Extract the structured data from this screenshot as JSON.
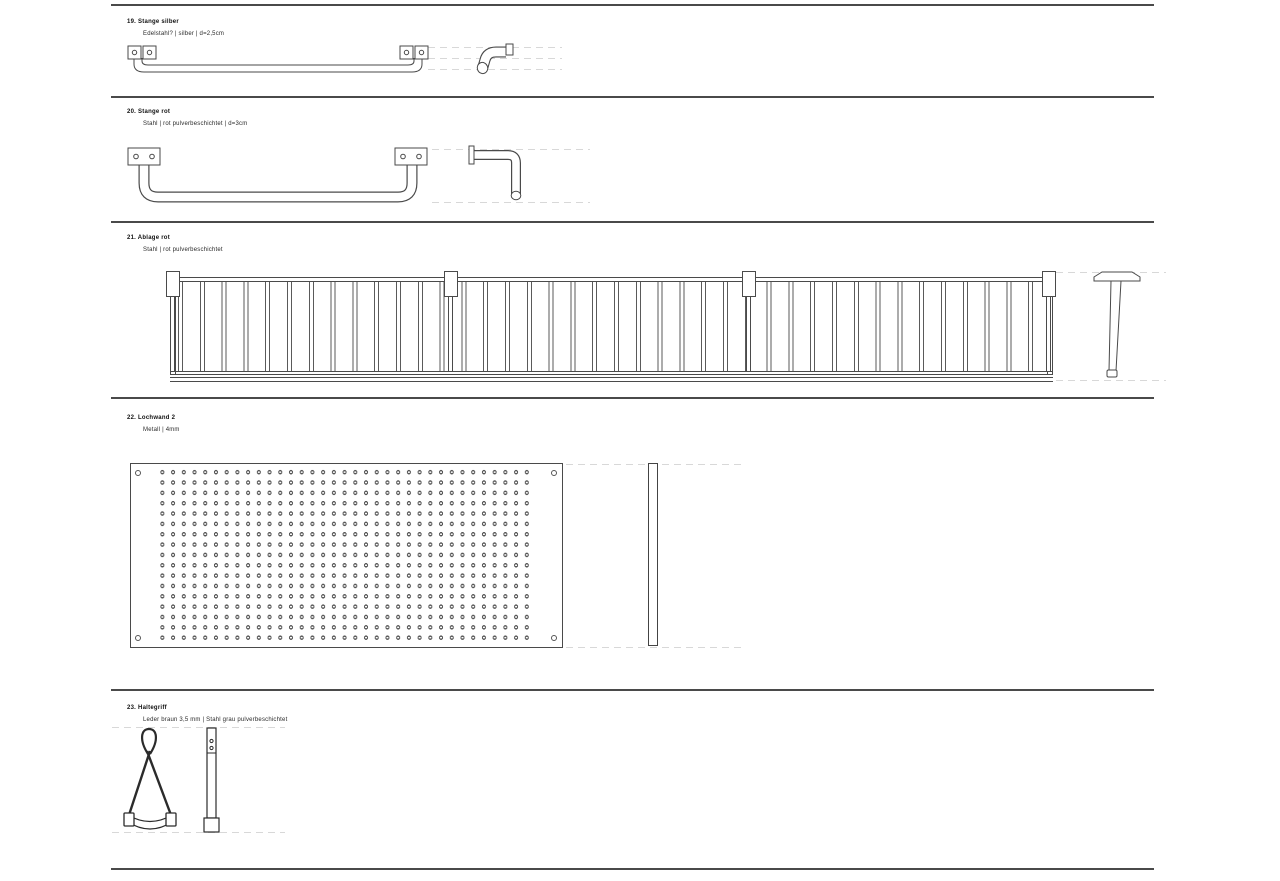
{
  "page": {
    "background": "#ffffff",
    "rule_color": "#4a4a4a",
    "drawing_line_color": "#4a4a4a",
    "dash_guide_color": "#d8d8d8"
  },
  "sections": [
    {
      "title": "19. Stange silber",
      "spec": "Edelstahl? | silber | d=2,5cm",
      "views": [
        "front-view-rod-with-wall-plates",
        "side-view-curved-pipe"
      ]
    },
    {
      "title": "20. Stange rot",
      "spec": "Stahl | rot pulverbeschichtet | d=3cm",
      "views": [
        "front-view-u-shaped-rod-with-wall-plates",
        "side-view-l-shaped-rod"
      ]
    },
    {
      "title": "21. Ablage rot",
      "spec": "Stahl | rot pulverbeschichtet",
      "views": [
        "front-view-slatted-rack",
        "side-view-t-bracket"
      ]
    },
    {
      "title": "22. Lochwand 2",
      "spec": "Metall | 4mm",
      "views": [
        "front-view-perforated-panel",
        "side-view-panel-edge"
      ]
    },
    {
      "title": "23. Haltegriff",
      "spec": "Leder braun 3,5 mm | Stahl grau pulverbeschichtet",
      "views": [
        "front-view-leather-strap-handle",
        "side-view-strap-edge"
      ]
    }
  ]
}
